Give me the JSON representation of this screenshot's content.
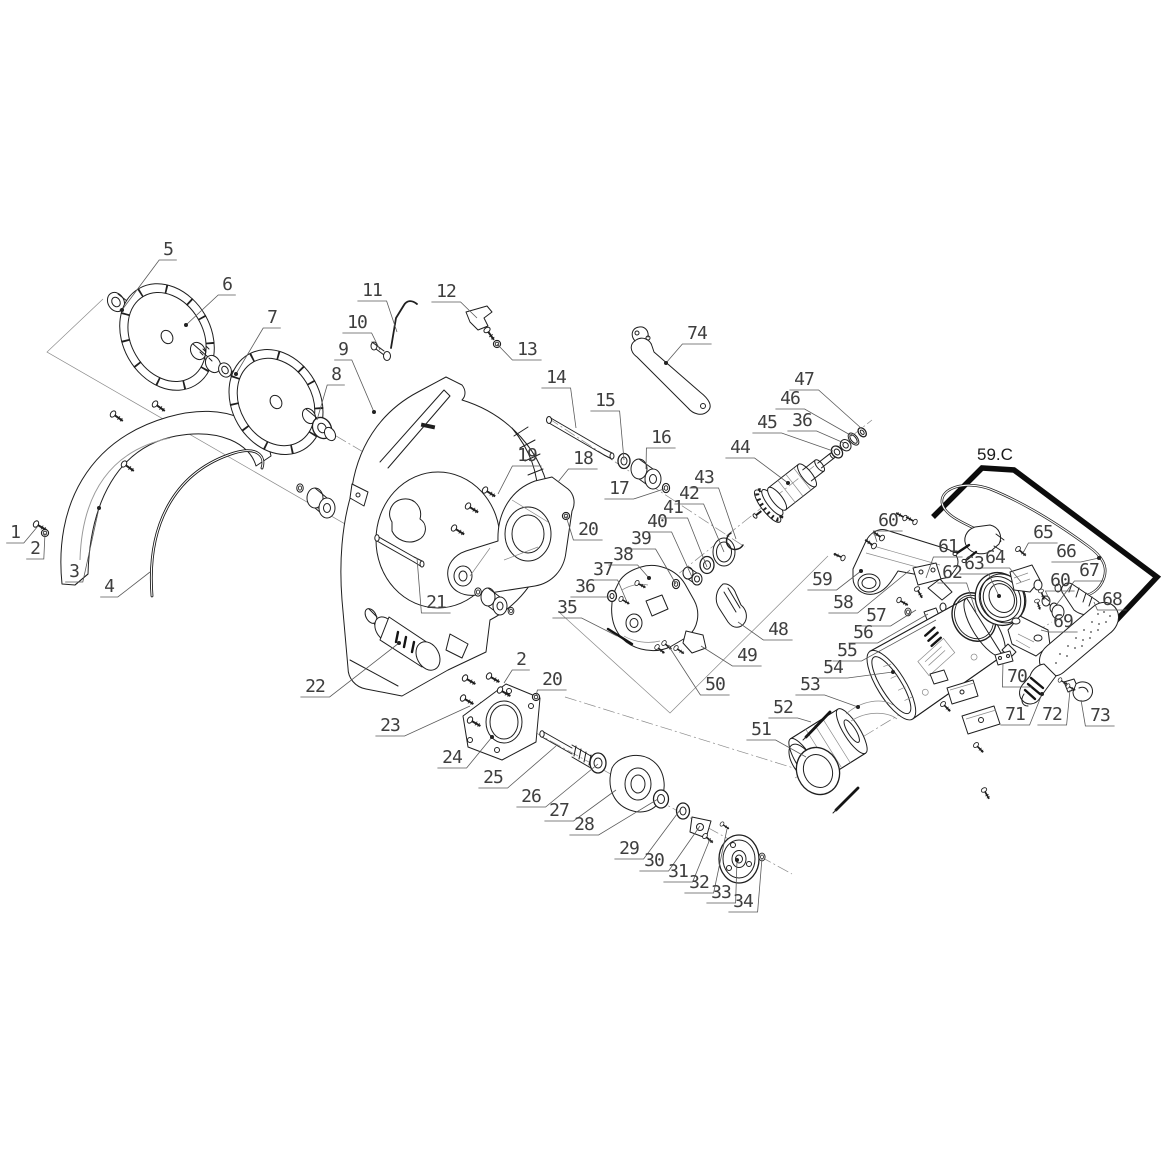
{
  "zone": {
    "label": "59.C"
  },
  "colors": {
    "line": "#1f1f1f",
    "thin": "#8a8a8a",
    "label": "#3e3e3e",
    "frame": "#0c0c0c",
    "background": "#ffffff"
  },
  "callouts": [
    {
      "t": "1",
      "x": 15,
      "y": 538,
      "ex": 38,
      "ey": 526,
      "dot": 0
    },
    {
      "t": "2",
      "x": 35,
      "y": 554,
      "ex": 45,
      "ey": 533,
      "dot": 0
    },
    {
      "t": "3",
      "x": 74,
      "y": 577,
      "ex": 99,
      "ey": 508,
      "dot": 1
    },
    {
      "t": "4",
      "x": 109,
      "y": 592,
      "ex": 150,
      "ey": 572,
      "dot": 0
    },
    {
      "t": "5",
      "x": 168,
      "y": 255,
      "ex": 122,
      "ey": 310,
      "dot": 1
    },
    {
      "t": "6",
      "x": 227,
      "y": 290,
      "ex": 186,
      "ey": 325,
      "dot": 1
    },
    {
      "t": "7",
      "x": 272,
      "y": 323,
      "ex": 236,
      "ey": 374,
      "dot": 1
    },
    {
      "t": "8",
      "x": 336,
      "y": 380,
      "ex": 317,
      "ey": 420,
      "dot": 0
    },
    {
      "t": "9",
      "x": 343,
      "y": 355,
      "ex": 374,
      "ey": 412,
      "dot": 1
    },
    {
      "t": "10",
      "x": 357,
      "y": 328,
      "ex": 380,
      "ey": 350,
      "dot": 0
    },
    {
      "t": "11",
      "x": 372,
      "y": 296,
      "ex": 397,
      "ey": 332,
      "dot": 0
    },
    {
      "t": "12",
      "x": 446,
      "y": 297,
      "ex": 477,
      "ey": 318,
      "dot": 0
    },
    {
      "t": "13",
      "x": 527,
      "y": 355,
      "ex": 497,
      "ey": 344,
      "dot": 0
    },
    {
      "t": "14",
      "x": 556,
      "y": 383,
      "ex": 576,
      "ey": 428,
      "dot": 0
    },
    {
      "t": "15",
      "x": 605,
      "y": 406,
      "ex": 624,
      "ey": 460,
      "dot": 0
    },
    {
      "t": "16",
      "x": 661,
      "y": 443,
      "ex": 646,
      "ey": 469,
      "dot": 0
    },
    {
      "t": "17",
      "x": 619,
      "y": 494,
      "ex": 664,
      "ey": 489,
      "dot": 0
    },
    {
      "t": "18",
      "x": 583,
      "y": 464,
      "ex": 558,
      "ey": 482,
      "dot": 0
    },
    {
      "t": "19",
      "x": 527,
      "y": 461,
      "ex": 498,
      "ey": 494,
      "dot": 0
    },
    {
      "t": "20",
      "x": 588,
      "y": 535,
      "ex": 566,
      "ey": 516,
      "dot": 0
    },
    {
      "t": "21",
      "x": 436,
      "y": 608,
      "ex": 417,
      "ey": 558,
      "dot": 0
    },
    {
      "t": "22",
      "x": 315,
      "y": 692,
      "ex": 399,
      "ey": 643,
      "dot": 1
    },
    {
      "t": "23",
      "x": 390,
      "y": 731,
      "ex": 470,
      "ey": 706,
      "dot": 0
    },
    {
      "t": "2",
      "x": 521,
      "y": 665,
      "ex": 504,
      "ey": 683,
      "dot": 0
    },
    {
      "t": "20",
      "x": 552,
      "y": 685,
      "ex": 536,
      "ey": 696,
      "dot": 0
    },
    {
      "t": "24",
      "x": 452,
      "y": 763,
      "ex": 492,
      "ey": 737,
      "dot": 1
    },
    {
      "t": "25",
      "x": 493,
      "y": 783,
      "ex": 556,
      "ey": 746,
      "dot": 0
    },
    {
      "t": "26",
      "x": 531,
      "y": 802,
      "ex": 598,
      "ey": 764,
      "dot": 0
    },
    {
      "t": "27",
      "x": 559,
      "y": 816,
      "ex": 616,
      "ey": 790,
      "dot": 0
    },
    {
      "t": "28",
      "x": 584,
      "y": 830,
      "ex": 658,
      "ey": 799,
      "dot": 0
    },
    {
      "t": "29",
      "x": 629,
      "y": 854,
      "ex": 680,
      "ey": 810,
      "dot": 0
    },
    {
      "t": "30",
      "x": 654,
      "y": 866,
      "ex": 700,
      "ey": 826,
      "dot": 0
    },
    {
      "t": "31",
      "x": 678,
      "y": 877,
      "ex": 710,
      "ey": 839,
      "dot": 0
    },
    {
      "t": "32",
      "x": 699,
      "y": 888,
      "ex": 727,
      "ey": 829,
      "dot": 0
    },
    {
      "t": "33",
      "x": 721,
      "y": 898,
      "ex": 737,
      "ey": 860,
      "dot": 1
    },
    {
      "t": "34",
      "x": 743,
      "y": 907,
      "ex": 762,
      "ey": 858,
      "dot": 0
    },
    {
      "t": "35",
      "x": 567,
      "y": 613,
      "ex": 617,
      "ey": 636,
      "dot": 0
    },
    {
      "t": "36",
      "x": 585,
      "y": 592,
      "ex": 611,
      "ey": 597,
      "dot": 0
    },
    {
      "t": "37",
      "x": 603,
      "y": 575,
      "ex": 627,
      "ey": 602,
      "dot": 0
    },
    {
      "t": "38",
      "x": 623,
      "y": 560,
      "ex": 649,
      "ey": 578,
      "dot": 1
    },
    {
      "t": "39",
      "x": 641,
      "y": 544,
      "ex": 676,
      "ey": 584,
      "dot": 0
    },
    {
      "t": "40",
      "x": 657,
      "y": 527,
      "ex": 692,
      "ey": 577,
      "dot": 0
    },
    {
      "t": "41",
      "x": 673,
      "y": 513,
      "ex": 707,
      "ey": 567,
      "dot": 0
    },
    {
      "t": "42",
      "x": 689,
      "y": 499,
      "ex": 724,
      "ey": 552,
      "dot": 0
    },
    {
      "t": "43",
      "x": 704,
      "y": 483,
      "ex": 736,
      "ey": 539,
      "dot": 0
    },
    {
      "t": "44",
      "x": 740,
      "y": 453,
      "ex": 788,
      "ey": 483,
      "dot": 1
    },
    {
      "t": "45",
      "x": 767,
      "y": 428,
      "ex": 833,
      "ey": 451,
      "dot": 0
    },
    {
      "t": "36",
      "x": 802,
      "y": 426,
      "ex": 844,
      "ey": 443,
      "dot": 0
    },
    {
      "t": "46",
      "x": 790,
      "y": 404,
      "ex": 852,
      "ey": 436,
      "dot": 0
    },
    {
      "t": "47",
      "x": 804,
      "y": 385,
      "ex": 861,
      "ey": 428,
      "dot": 0
    },
    {
      "t": "48",
      "x": 778,
      "y": 635,
      "ex": 738,
      "ey": 622,
      "dot": 0
    },
    {
      "t": "49",
      "x": 747,
      "y": 661,
      "ex": 701,
      "ey": 646,
      "dot": 0
    },
    {
      "t": "50",
      "x": 715,
      "y": 690,
      "ex": 668,
      "ey": 645,
      "dot": 0
    },
    {
      "t": "51",
      "x": 761,
      "y": 735,
      "ex": 806,
      "ey": 757,
      "dot": 0
    },
    {
      "t": "52",
      "x": 783,
      "y": 713,
      "ex": 811,
      "ey": 722,
      "dot": 0
    },
    {
      "t": "53",
      "x": 810,
      "y": 690,
      "ex": 858,
      "ey": 707,
      "dot": 1
    },
    {
      "t": "54",
      "x": 833,
      "y": 673,
      "ex": 893,
      "ey": 672,
      "dot": 1
    },
    {
      "t": "55",
      "x": 847,
      "y": 656,
      "ex": 936,
      "ey": 620,
      "dot": 0
    },
    {
      "t": "56",
      "x": 863,
      "y": 638,
      "ex": 928,
      "ey": 614,
      "dot": 0
    },
    {
      "t": "57",
      "x": 876,
      "y": 621,
      "ex": 916,
      "ey": 610,
      "dot": 0
    },
    {
      "t": "58",
      "x": 843,
      "y": 608,
      "ex": 910,
      "ey": 570,
      "dot": 0
    },
    {
      "t": "59",
      "x": 822,
      "y": 585,
      "ex": 861,
      "ey": 571,
      "dot": 1
    },
    {
      "t": "60",
      "x": 888,
      "y": 526,
      "ex": 877,
      "ey": 542,
      "dot": 0
    },
    {
      "t": "61",
      "x": 948,
      "y": 552,
      "ex": 926,
      "ey": 578,
      "dot": 0
    },
    {
      "t": "62",
      "x": 952,
      "y": 578,
      "ex": 976,
      "ey": 612,
      "dot": 0
    },
    {
      "t": "63",
      "x": 974,
      "y": 569,
      "ex": 999,
      "ey": 596,
      "dot": 1
    },
    {
      "t": "64",
      "x": 995,
      "y": 563,
      "ex": 1021,
      "ey": 582,
      "dot": 0
    },
    {
      "t": "65",
      "x": 1043,
      "y": 538,
      "ex": 1023,
      "ey": 553,
      "dot": 0
    },
    {
      "t": "66",
      "x": 1066,
      "y": 557,
      "ex": 1099,
      "ey": 558,
      "dot": 1
    },
    {
      "t": "67",
      "x": 1089,
      "y": 576,
      "ex": 1057,
      "ey": 604,
      "dot": 0
    },
    {
      "t": "68",
      "x": 1112,
      "y": 605,
      "ex": 1094,
      "ey": 602,
      "dot": 0
    },
    {
      "t": "60",
      "x": 1060,
      "y": 586,
      "ex": 1050,
      "ey": 601,
      "dot": 0
    },
    {
      "t": "69",
      "x": 1063,
      "y": 627,
      "ex": 1041,
      "ey": 630,
      "dot": 0
    },
    {
      "t": "70",
      "x": 1017,
      "y": 682,
      "ex": 1003,
      "ey": 663,
      "dot": 0
    },
    {
      "t": "71",
      "x": 1015,
      "y": 720,
      "ex": 1042,
      "ey": 694,
      "dot": 1
    },
    {
      "t": "72",
      "x": 1052,
      "y": 720,
      "ex": 1070,
      "ey": 690,
      "dot": 0
    },
    {
      "t": "73",
      "x": 1100,
      "y": 721,
      "ex": 1081,
      "ey": 700,
      "dot": 0
    },
    {
      "t": "74",
      "x": 697,
      "y": 339,
      "ex": 666,
      "ey": 363,
      "dot": 1
    }
  ]
}
